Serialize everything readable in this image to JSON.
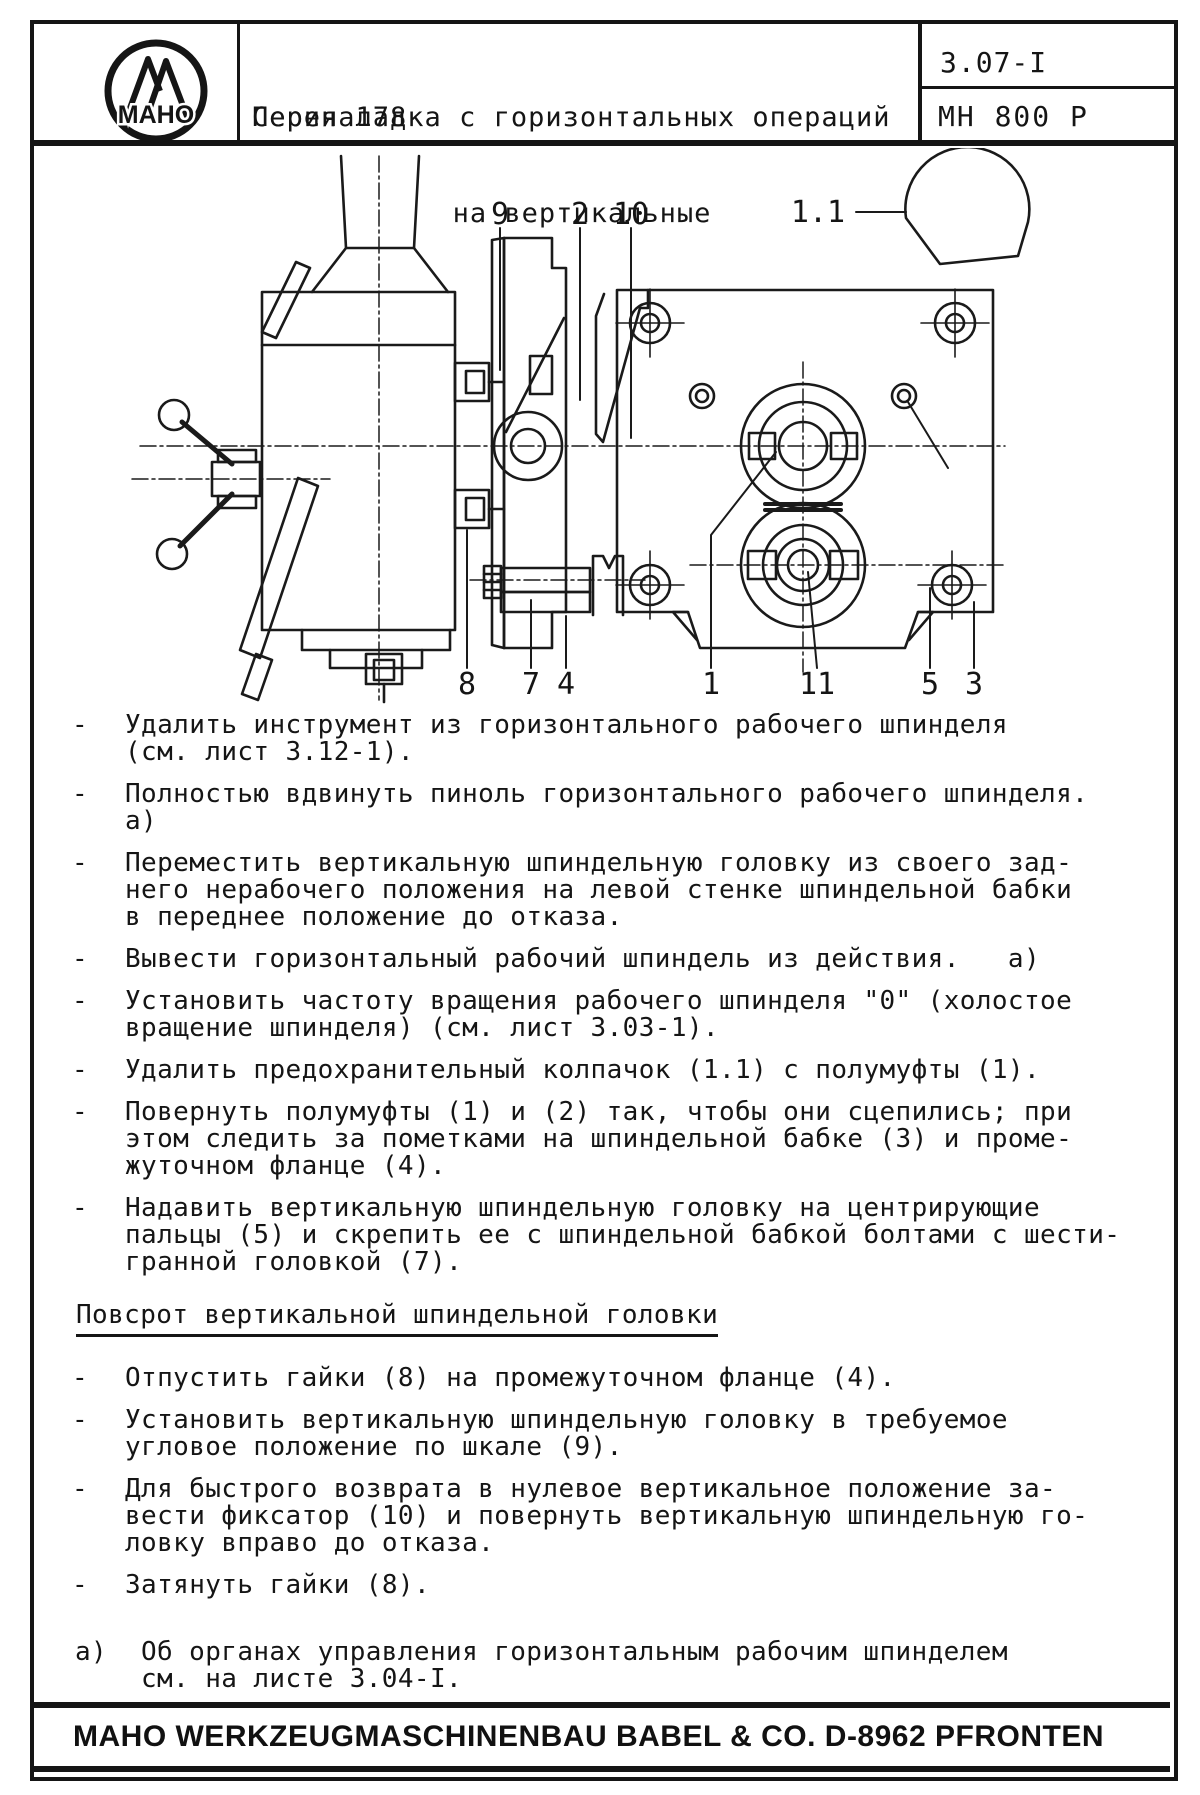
{
  "header": {
    "logo": "MAHO",
    "title_line1": "Переналадка с горизонтальных операций",
    "title_line2": "на вертикальные",
    "series": "Серия 178",
    "doc_code": "3.07-I",
    "model": "MH 800 P"
  },
  "diagram": {
    "callouts_top": [
      {
        "label": "9"
      },
      {
        "label": "2"
      },
      {
        "label": "10"
      },
      {
        "label": "1.1"
      }
    ],
    "callouts_bottom": [
      {
        "label": "8"
      },
      {
        "label": "7"
      },
      {
        "label": "4"
      },
      {
        "label": "1"
      },
      {
        "label": "11"
      },
      {
        "label": "5"
      },
      {
        "label": "3"
      }
    ]
  },
  "bullet_marker": "-",
  "instructions": [
    {
      "lines": [
        "Удалить инструмент из горизонтального рабочего шпинделя",
        "(см. лист 3.12-1)."
      ]
    },
    {
      "lines": [
        "Полностью вдвинуть пиноль горизонтального рабочего шпинделя.",
        "а)"
      ]
    },
    {
      "lines": [
        "Переместить вертикальную шпиндельную головку из своего зад-",
        "него нерабочего положения на левой стенке шпиндельной бабки",
        "в переднее положение до отказа."
      ]
    },
    {
      "lines": [
        "Вывести горизонтальный рабочий шпиндель из действия.   а)"
      ]
    },
    {
      "lines": [
        "Установить частоту вращения рабочего шпинделя \"0\" (холостое",
        "вращение шпинделя) (см. лист 3.03-1)."
      ]
    },
    {
      "lines": [
        "Удалить предохранительный колпачок (1.1) с полумуфты (1)."
      ]
    },
    {
      "lines": [
        "Повернуть полумуфты (1) и (2) так, чтобы они сцепились; при",
        "этом следить за пометками на шпиндельной бабке (3) и проме-",
        "жуточном фланце (4)."
      ]
    },
    {
      "lines": [
        "Надавить вертикальную шпиндельную головку на центрирующие",
        "пальцы (5) и скрепить ее с шпиндельной бабкой болтами с шести-",
        "гранной головкой (7)."
      ]
    }
  ],
  "section": {
    "heading": "Повсрот вертикальной шпиндельной головки",
    "instructions": [
      {
        "lines": [
          "Отпустить гайки (8) на промежуточном фланце (4)."
        ]
      },
      {
        "lines": [
          "Установить вертикальную шпиндельную головку в требуемое",
          "угловое положение по шкале (9)."
        ]
      },
      {
        "lines": [
          "Для быстрого возврата в нулевое вертикальное положение за-",
          "вести фиксатор (10) и повернуть вертикальную шпиндельную го-",
          "ловку вправо до отказа."
        ]
      },
      {
        "lines": [
          "Затянуть гайки (8)."
        ]
      }
    ]
  },
  "footnote": {
    "marker": "а)",
    "lines": [
      "Об органах управления горизонтальным рабочим шпинделем",
      "см. на листе 3.04-I."
    ]
  },
  "footer": {
    "company": "MAHO WERKZEUGMASCHINENBAU BABEL & CO. D-8962 PFRONTEN"
  }
}
